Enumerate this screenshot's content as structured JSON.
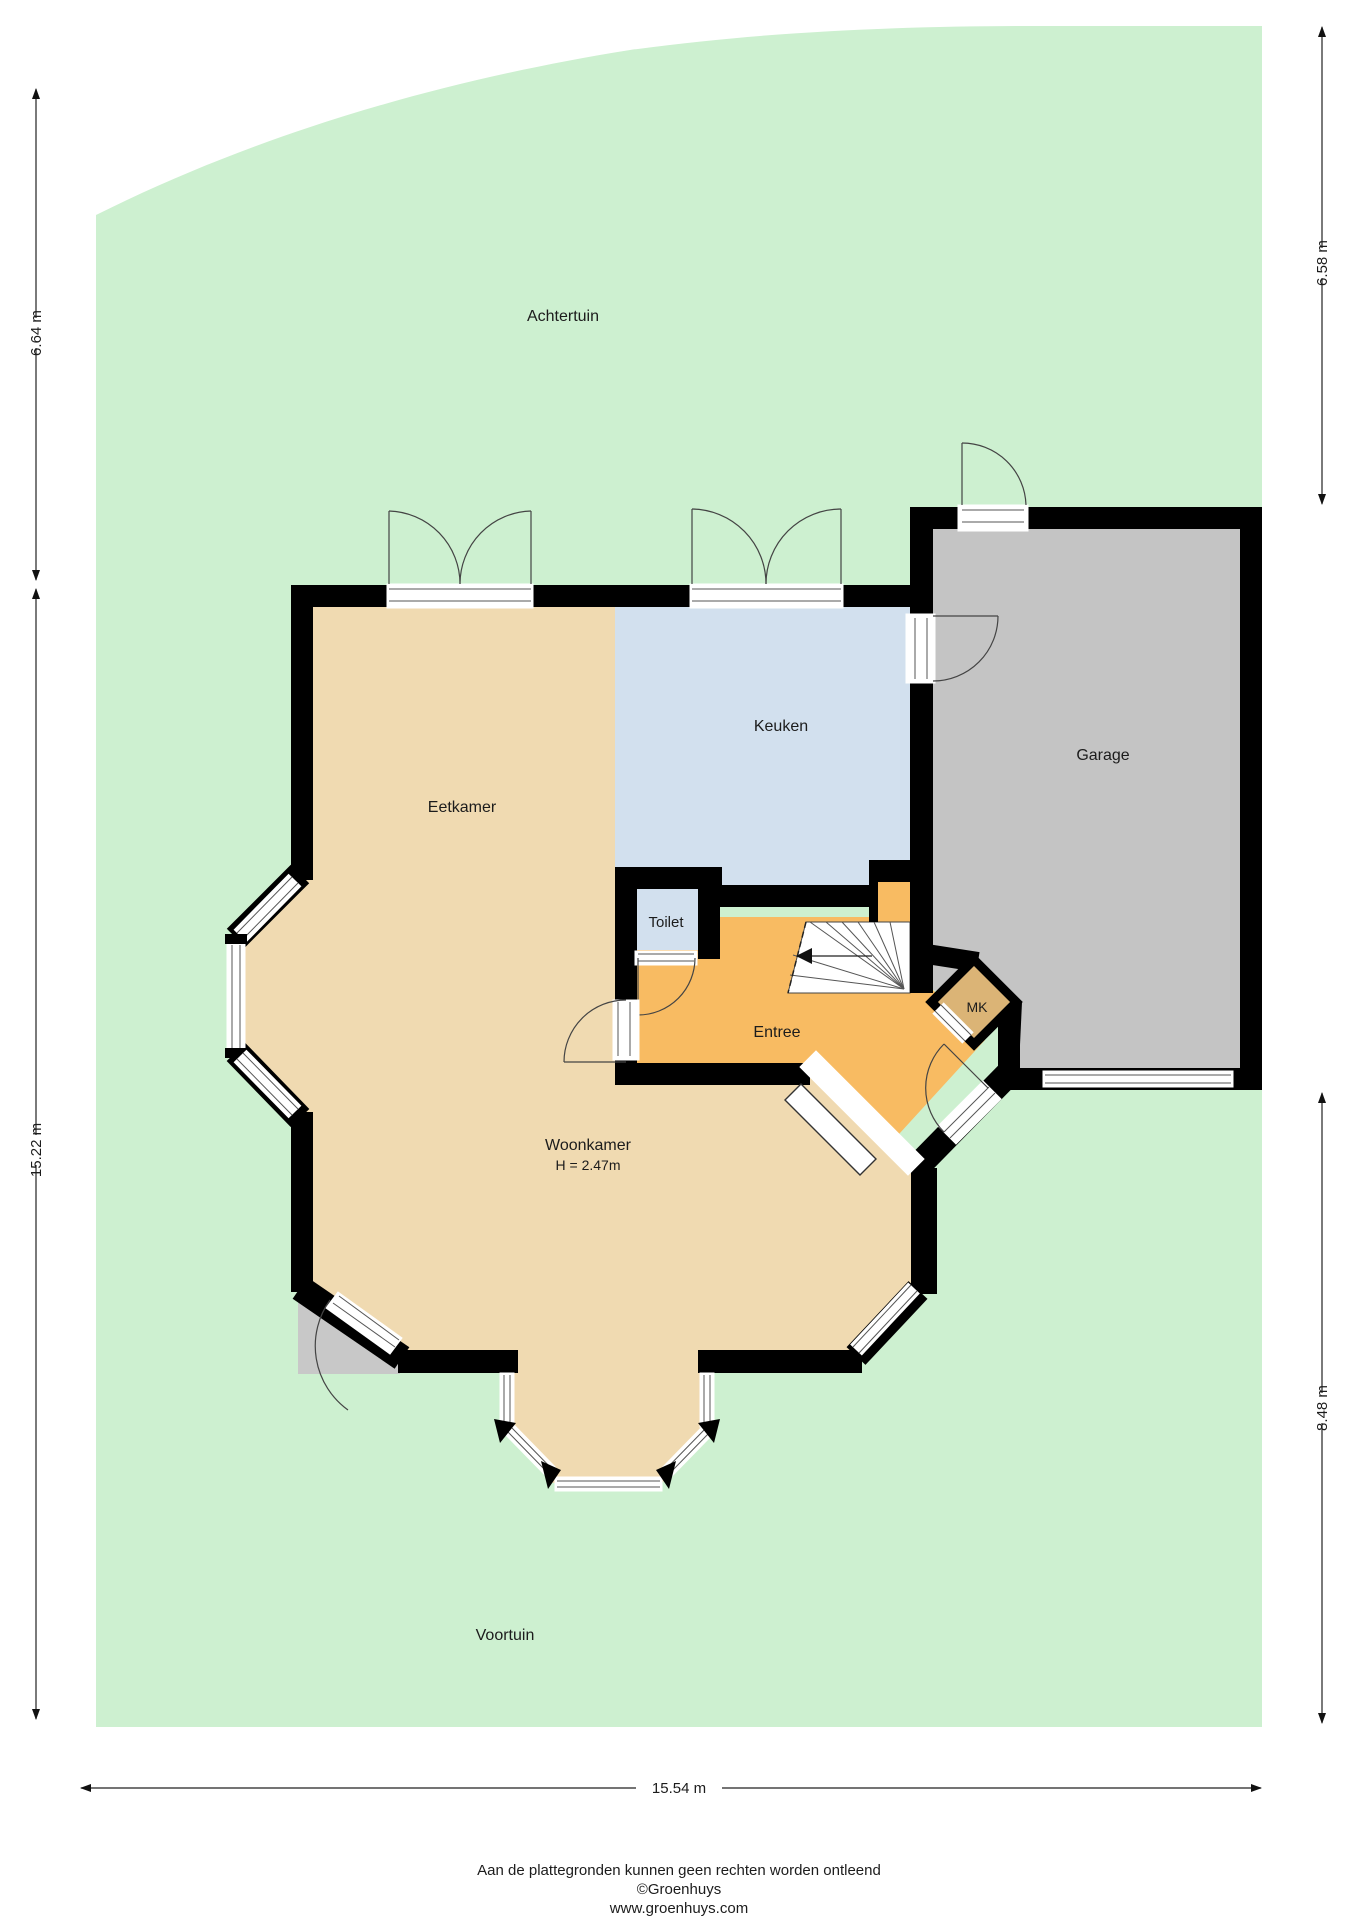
{
  "plan": {
    "type": "floorplan",
    "rooms": {
      "achtertuin": "Achtertuin",
      "voortuin": "Voortuin",
      "eetkamer": "Eetkamer",
      "keuken": "Keuken",
      "garage": "Garage",
      "toilet": "Toilet",
      "entree": "Entree",
      "mk": "MK",
      "woonkamer": "Woonkamer",
      "woonkamer_height": "H = 2.47m"
    },
    "dimensions": {
      "left_upper": "6.64 m",
      "left_lower": "15.22 m",
      "right_upper": "6.58 m",
      "right_lower": "8.48 m",
      "bottom": "15.54 m"
    },
    "footer": {
      "disclaimer": "Aan de plattegronden kunnen geen rechten worden ontleend",
      "copyright": "©Groenhuys",
      "website": "www.groenhuys.com"
    },
    "colors": {
      "garden": "#cdf0d0",
      "floor_tan": "#f0dab1",
      "kitchen_blue": "#d2e0ee",
      "hall_orange": "#f8bb62",
      "mk_tan": "#dbb476",
      "garage_gray": "#c4c4c4",
      "porch_gray": "#c8c8c8",
      "stairs_white": "#ffffff",
      "wall_black": "#000000"
    }
  }
}
